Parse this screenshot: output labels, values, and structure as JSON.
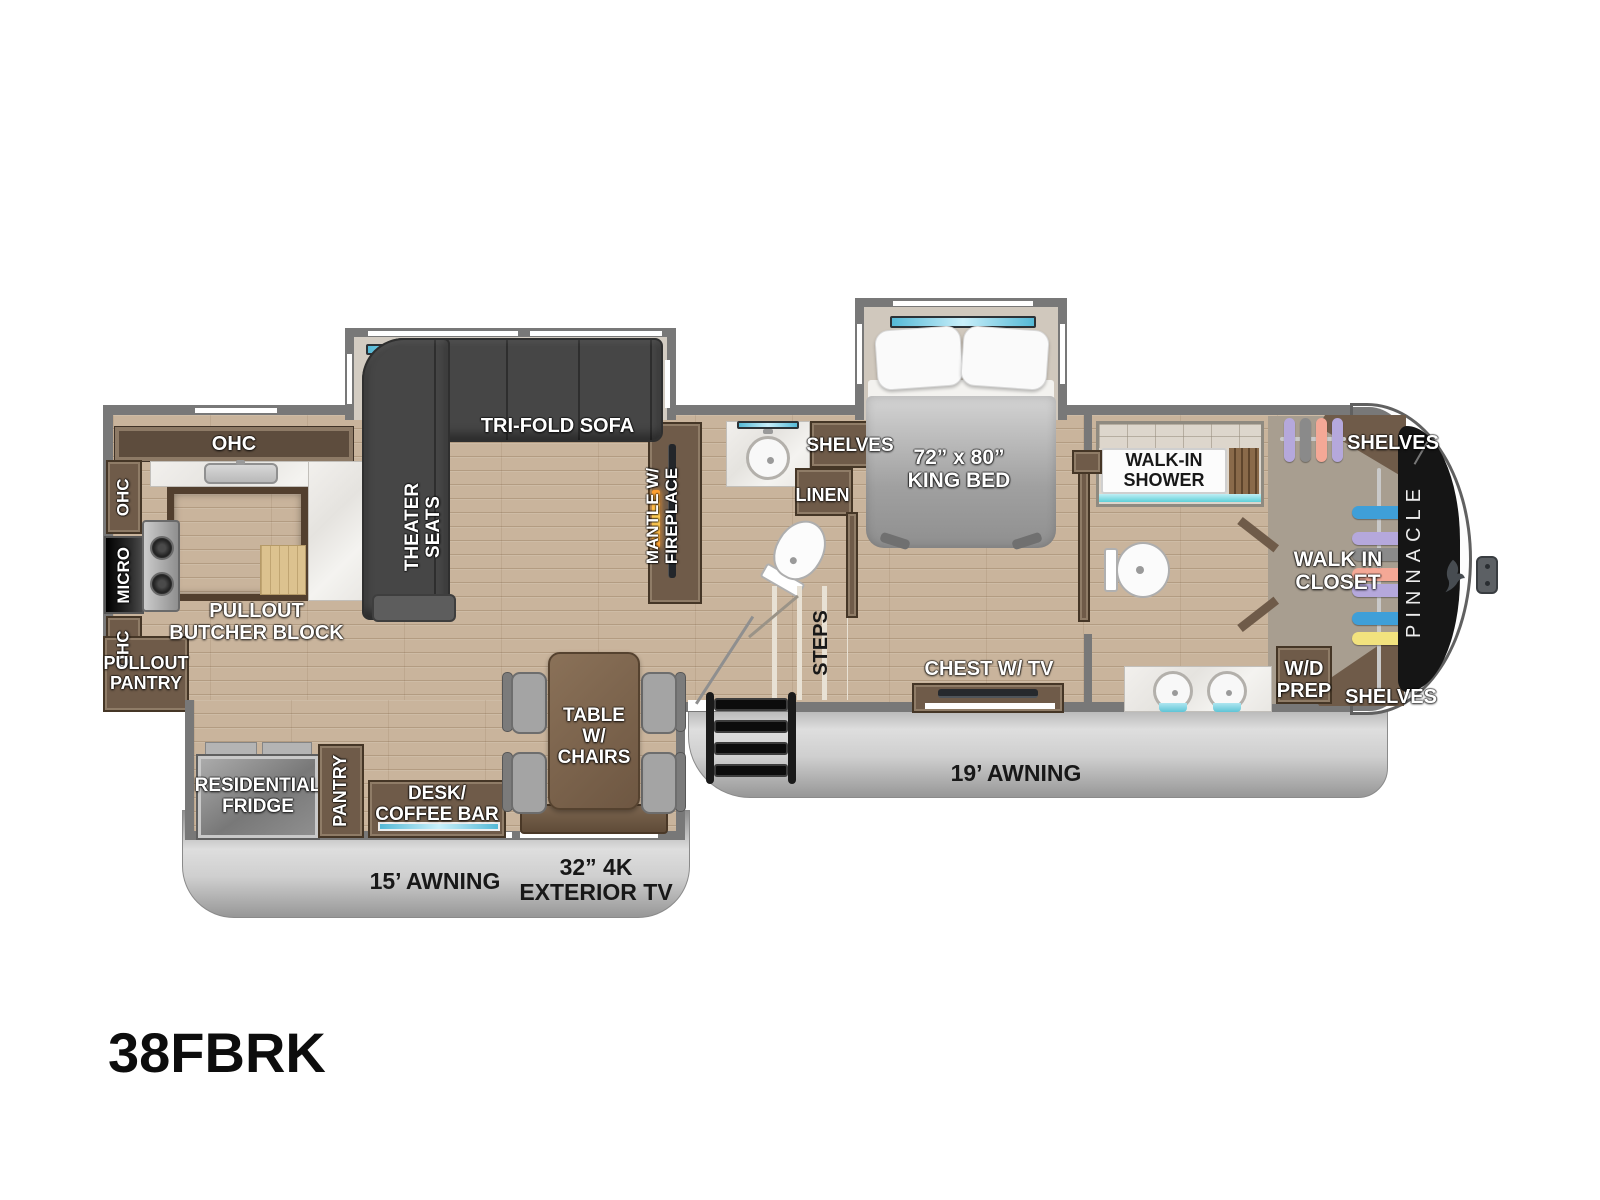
{
  "model": "38FBRK",
  "brand": {
    "front_cap": "PINNACLE"
  },
  "kitchen": {
    "ohc_top": "OHC",
    "ohc_upper": "OHC",
    "micro": "MICRO",
    "ohc_lower": "OHC",
    "pullout_pantry": "PULLOUT\nPANTRY",
    "butcher_block": "PULLOUT\nBUTCHER BLOCK"
  },
  "living": {
    "sofa": "TRI-FOLD SOFA",
    "theater_seats": "THEATER\nSEATS",
    "fireplace": "MANTLE W/\nFIREPLACE"
  },
  "mid_bath": {
    "shelves": "SHELVES",
    "linen": "LINEN"
  },
  "hall": {
    "steps": "STEPS"
  },
  "bedroom": {
    "bed": "72” x 80”\nKING BED",
    "chest": "CHEST W/ TV"
  },
  "front_bath": {
    "shower": "WALK-IN\nSHOWER"
  },
  "closet": {
    "label": "WALK IN\nCLOSET",
    "shelves_top": "SHELVES",
    "shelves_bottom": "SHELVES",
    "wd_prep": "W/D\nPREP"
  },
  "dinette": {
    "fridge": "RESIDENTIAL\nFRIDGE",
    "pantry": "PANTRY",
    "desk": "DESK/\nCOFFEE BAR",
    "table": "TABLE W/\nCHAIRS"
  },
  "exterior": {
    "awning_left": "15’ AWNING",
    "awning_right": "19’ AWNING",
    "exterior_tv": "32” 4K\nEXTERIOR TV"
  },
  "colors": {
    "wall": "#787878",
    "floor": "#c9b49c",
    "cabinet": "#6f5b49",
    "closet_floor": "#a89e90",
    "accent_teal": "#5fd0d8",
    "window_glass": "#55b9d6",
    "awning": "#cfcfcf",
    "front_cap_panel": "#151515",
    "fireplace_glow": "#ff9d2e",
    "hanger_blue": "#3f9fd8",
    "hanger_purple": "#b5a8dc",
    "hanger_gray": "#8a8a8a",
    "hanger_salmon": "#f4a896",
    "hanger_yellow": "#f2e27e"
  }
}
